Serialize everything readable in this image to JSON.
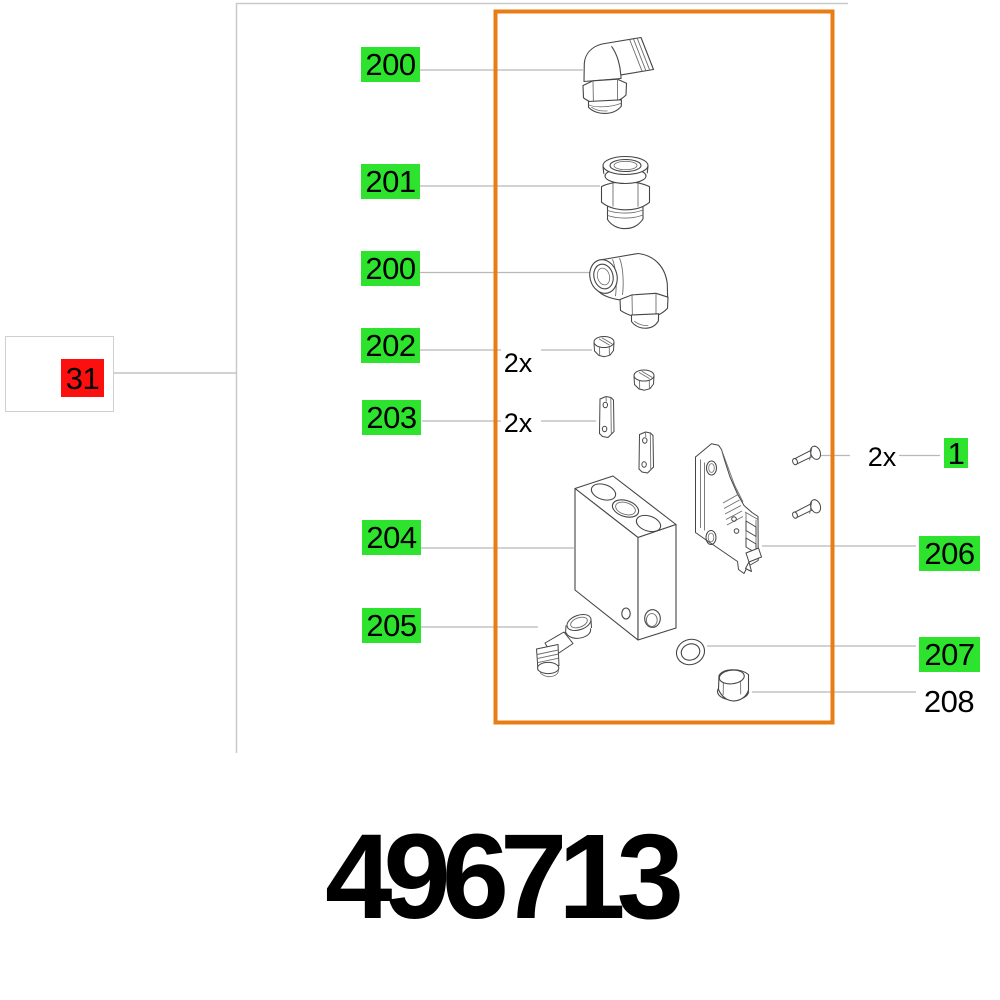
{
  "page": {
    "part_number": "496713"
  },
  "legend_colors": {
    "available_green": "#2de32d",
    "selected_red": "#fb0f0f",
    "highlight_orange": "#e87c15"
  },
  "callouts": {
    "c31": {
      "text": "31"
    },
    "c200_top": {
      "text": "200"
    },
    "c201": {
      "text": "201"
    },
    "c200_mid": {
      "text": "200"
    },
    "c202": {
      "text": "202",
      "qty": "2x"
    },
    "c203": {
      "text": "203",
      "qty": "2x"
    },
    "c204": {
      "text": "204"
    },
    "c205": {
      "text": "205"
    },
    "c206": {
      "text": "206"
    },
    "c207": {
      "text": "207"
    },
    "c208": {
      "text": "208"
    },
    "c1": {
      "text": "1",
      "qty": "2x"
    }
  },
  "parts": {
    "p200_top": "elbow-push-in-fitting",
    "p201": "straight-push-in-fitting",
    "p200_mid": "elbow-push-in-fitting",
    "p202": "hex-union-nut-2x",
    "p203": "clamp-plate-2x",
    "p204": "valve-block",
    "p205": "small-elbow-fitting",
    "p206": "mounting-plate",
    "p207": "sealing-ring",
    "p208": "screw-plug",
    "p1": "pan-head-screw-2x"
  }
}
